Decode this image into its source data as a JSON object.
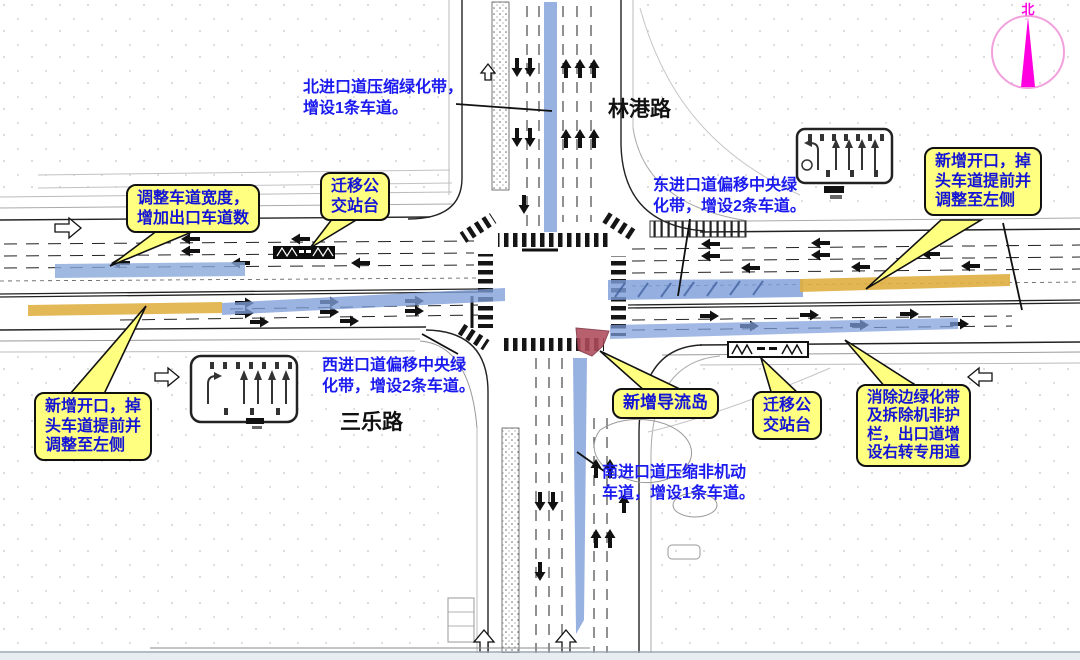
{
  "title": "交叉口改造方案图",
  "road_labels": {
    "north_road": "林港路",
    "west_road": "三乐路"
  },
  "compass": {
    "label": "北"
  },
  "notes": {
    "north": {
      "lines": [
        "北进口道压缩绿化带，",
        "增设1条车道。"
      ]
    },
    "east": {
      "lines": [
        "东进口道偏移中央绿",
        "化带，增设2条车道。"
      ]
    },
    "west": {
      "lines": [
        "西进口道偏移中央绿",
        "化带，增设2条车道。"
      ]
    },
    "south": {
      "lines": [
        "南进口道压缩非机动",
        "车道，增设1条车道。"
      ]
    }
  },
  "callouts": {
    "adjust_lane": {
      "lines": [
        "调整车道宽度，",
        "增加出口车道数"
      ]
    },
    "move_bus_top": {
      "lines": [
        "迁移公",
        "交站台"
      ]
    },
    "new_opening_right": {
      "lines": [
        "新增开口，掉",
        "头车道提前并",
        "调整至左侧"
      ]
    },
    "new_opening_left": {
      "lines": [
        "新增开口，掉",
        "头车道提前并",
        "调整至左侧"
      ]
    },
    "diversion_island": {
      "lines": [
        "新增导流岛"
      ]
    },
    "move_bus_bottom": {
      "lines": [
        "迁移公",
        "交站台"
      ]
    },
    "remove_greenbelt": {
      "lines": [
        "消除边绿化带",
        "及拆除机非护",
        "栏，出口道增",
        "设右转专用道"
      ]
    }
  },
  "colors": {
    "callout_bg": "#ffff80",
    "callout_text": "#1414d6",
    "note_text": "#1b1bef",
    "highlight_blue": "#7d9ed9",
    "highlight_orange": "#dfae3f",
    "island_red": "#b04b5c",
    "compass_magenta": "#ff00e0"
  }
}
